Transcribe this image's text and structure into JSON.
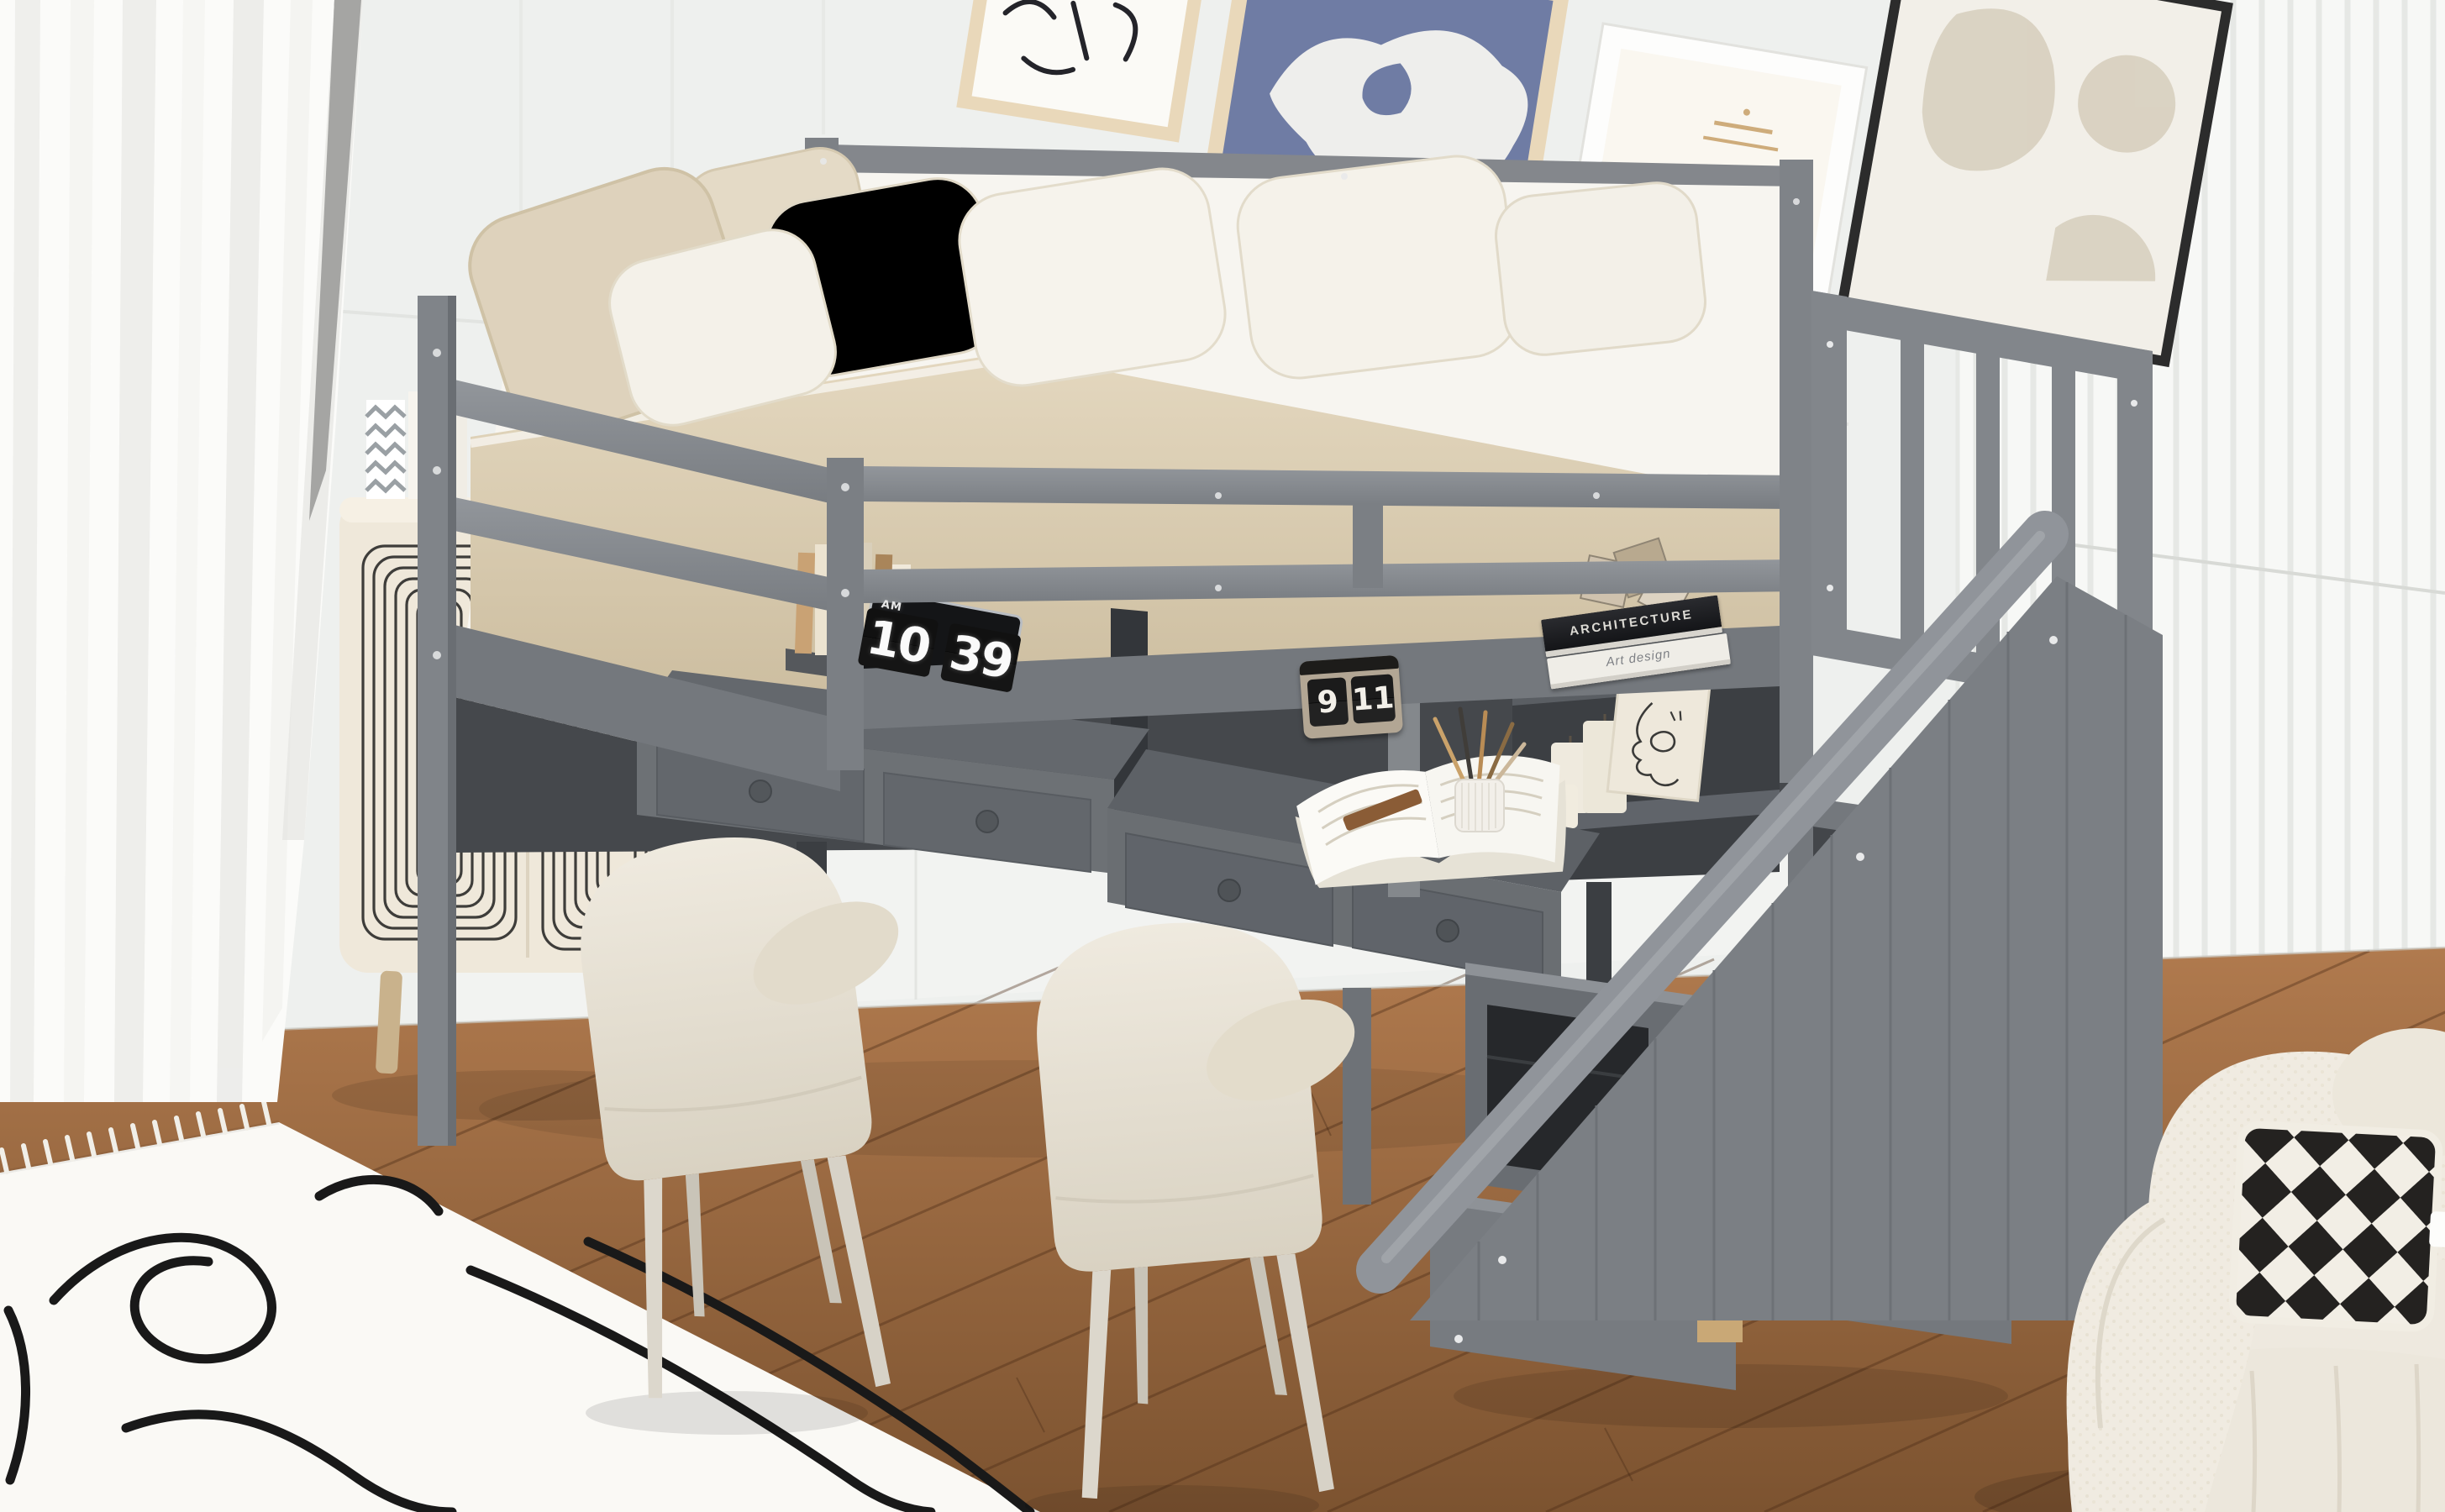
{
  "scene": {
    "type": "product-photo",
    "subject": "Gray twin loft bed with guardrails, built-in double desk workstation, storage staircase with cubbies, two cream desk chairs, cream cabinet with toys, boucle armchair, white line-art rug, wood floor, sheer curtains and gallery wall",
    "palette": {
      "bed_frame_gray": "#83878c",
      "desk_top_gray": "#5e6266",
      "wall_white": "#eef0ee",
      "slat_panel_white": "#f7f8f6",
      "floor_wood_brown": "#9c6a42",
      "rug_white": "#faf9f5",
      "bedding_beige": "#ddd0b8",
      "chair_cream": "#eae5da",
      "armchair_boucle_cream": "#f0ebe1",
      "basket_wicker_brown": "#8a6e4b",
      "cabinet_cream": "#efe8da",
      "pillow_checker_black": "#242220",
      "frame_art_blue": "#6f7ca4"
    },
    "laptop_clock": {
      "meridiem": "AM",
      "hour": "10",
      "minute": "39"
    },
    "flip_calendar": {
      "month": "9",
      "day": "11"
    },
    "book_stack": {
      "top_title": "ARCHITECTURE",
      "bottom_title": "Art design"
    }
  }
}
